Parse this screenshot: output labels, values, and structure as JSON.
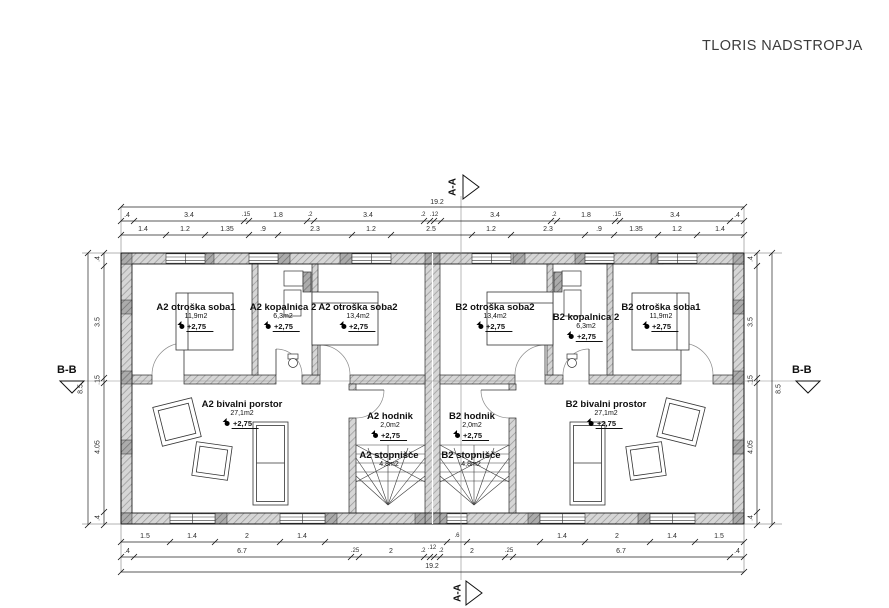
{
  "title": "TLORIS NADSTROPJA",
  "sections": {
    "aa": "A-A",
    "bb": "B-B"
  },
  "rooms": {
    "a2_soba1": {
      "name": "A2 otroška soba1",
      "area": "11,9m2",
      "level": "+2,75"
    },
    "a2_kopalnica": {
      "name": "A2 kopalnica 2",
      "area": "6,3m2",
      "level": "+2,75"
    },
    "a2_soba2": {
      "name": "A2 otroška soba2",
      "area": "13,4m2",
      "level": "+2,75"
    },
    "b2_soba2": {
      "name": "B2 otroška soba2",
      "area": "13,4m2",
      "level": "+2,75"
    },
    "b2_kopalnica": {
      "name": "B2 kopalnica 2",
      "area": "6,3m2",
      "level": "+2,75"
    },
    "b2_soba1": {
      "name": "B2 otroška soba1",
      "area": "11,9m2",
      "level": "+2,75"
    },
    "a2_bivalni": {
      "name": "A2 bivalni porstor",
      "area": "27,1m2",
      "level": "+2,75"
    },
    "b2_bivalni": {
      "name": "B2 bivalni prostor",
      "area": "27,1m2",
      "level": "+2,75"
    },
    "a2_hodnik": {
      "name": "A2 hodnik",
      "area": "2,0m2",
      "level": "+2,75"
    },
    "b2_hodnik": {
      "name": "B2 hodnik",
      "area": "2,0m2",
      "level": "+2,75"
    },
    "a2_stopnisce": {
      "name": "A2 stopnišče",
      "area": "4,8m2"
    },
    "b2_stopnisce": {
      "name": "B2 stopnišče",
      "area": "4,8m2"
    }
  },
  "dimensions": {
    "total_width": "19.2",
    "total_height": "8.5",
    "top_row2": [
      ".4",
      "3.4",
      ".15",
      "1.8",
      ".2",
      "3.4",
      ".2",
      ".12",
      "3.4",
      ".2",
      "1.8",
      ".15",
      "3.4",
      ".4"
    ],
    "top_row3": [
      "1.4",
      "1.2",
      "1.35",
      ".9",
      "2.3",
      "1.2",
      "2.5",
      "1.2",
      "2.3",
      ".9",
      "1.35",
      "1.2",
      "1.4"
    ],
    "bottom_row1": [
      "1.5",
      "1.4",
      "2",
      "1.4",
      ".6",
      "1.4",
      "2",
      "1.4",
      "1.5"
    ],
    "bottom_row2": [
      ".4",
      "6.7",
      ".25",
      "2",
      ".2",
      ".12",
      ".2",
      "2",
      ".25",
      "6.7",
      ".4"
    ],
    "left_col": [
      ".4",
      "3.5",
      ".15",
      "4.05",
      ".4"
    ],
    "right_col": [
      ".4",
      "3.5",
      ".15",
      "4.05",
      ".4"
    ]
  },
  "colors": {
    "line": "#222222",
    "wall_hatch_light": "#d6d6d6",
    "wall_hatch_dark": "#ababab",
    "text": "#101010",
    "title_text": "#3c3c3c"
  }
}
